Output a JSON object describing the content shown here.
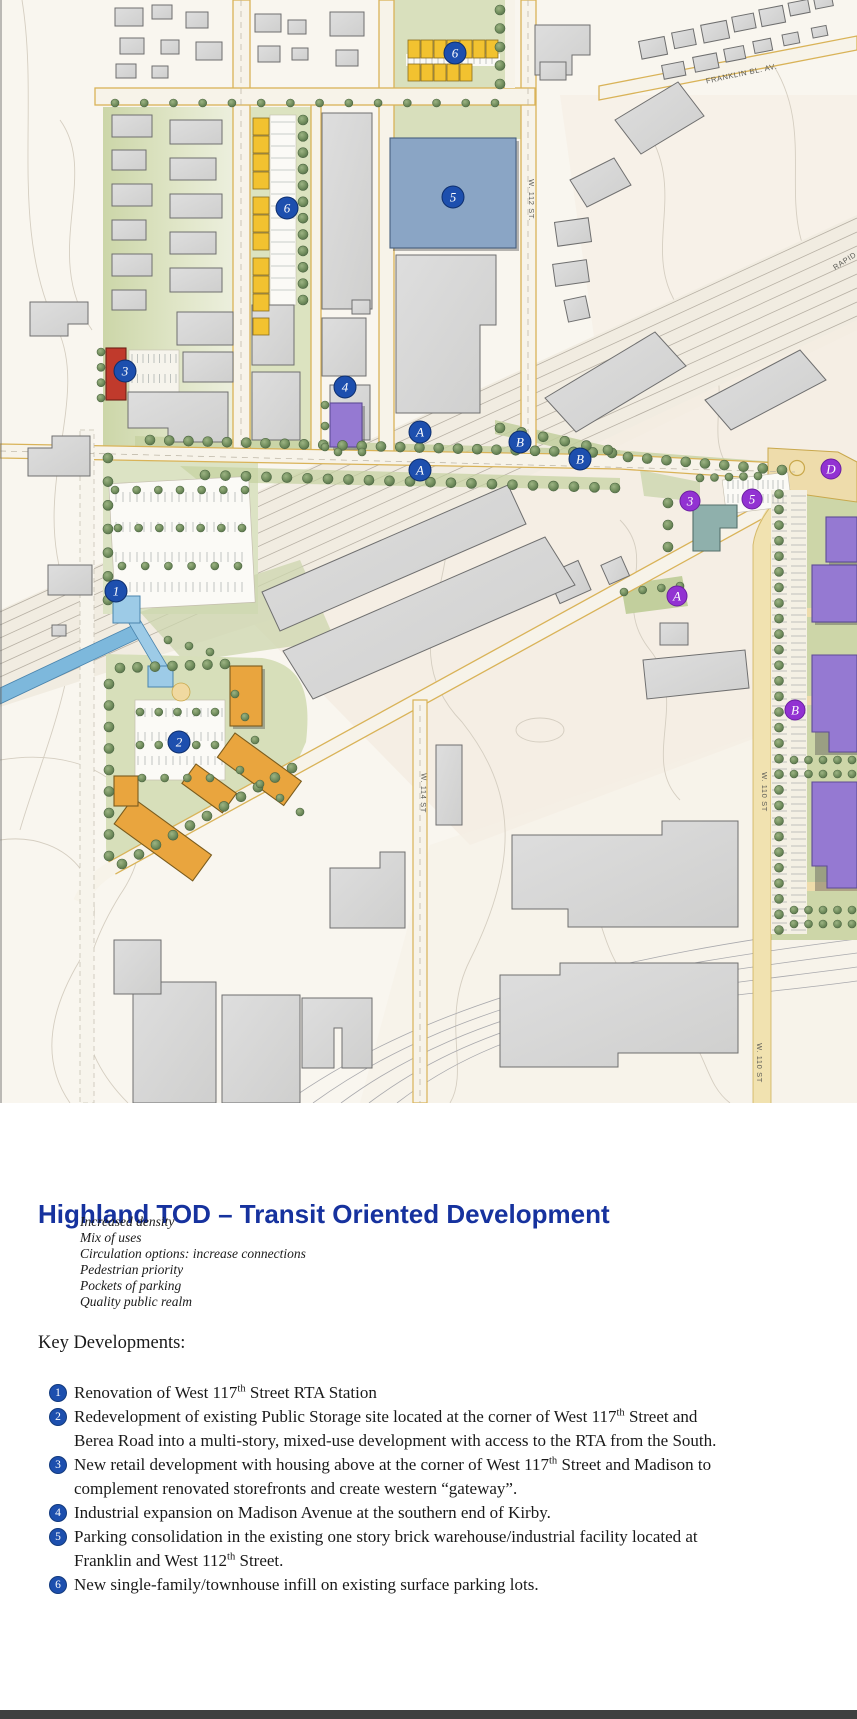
{
  "map": {
    "street_labels": [
      {
        "text": "FRANKLIN BL. AV.",
        "x": 742,
        "y": 76,
        "rot": -12
      },
      {
        "text": "W. 112 ST.",
        "x": 529,
        "y": 200,
        "rot": 90
      },
      {
        "text": "W. 114 ST",
        "x": 421,
        "y": 793,
        "rot": 91
      },
      {
        "text": "W. 110 ST",
        "x": 762,
        "y": 792,
        "rot": 90
      },
      {
        "text": "W. 110 ST",
        "x": 757,
        "y": 1063,
        "rot": 90
      },
      {
        "text": "RAPID",
        "x": 846,
        "y": 263,
        "rot": -33
      }
    ],
    "markers": [
      {
        "label": "1",
        "x": 116,
        "y": 591,
        "type": "blue"
      },
      {
        "label": "2",
        "x": 179,
        "y": 742,
        "type": "blue"
      },
      {
        "label": "3",
        "x": 125,
        "y": 371,
        "type": "blue"
      },
      {
        "label": "4",
        "x": 345,
        "y": 387,
        "type": "blue"
      },
      {
        "label": "5",
        "x": 453,
        "y": 197,
        "type": "blue"
      },
      {
        "label": "6",
        "x": 455,
        "y": 53,
        "type": "blue"
      },
      {
        "label": "6",
        "x": 287,
        "y": 208,
        "type": "blue"
      },
      {
        "label": "A",
        "x": 420,
        "y": 432,
        "type": "blue"
      },
      {
        "label": "A",
        "x": 420,
        "y": 470,
        "type": "blue"
      },
      {
        "label": "B",
        "x": 520,
        "y": 442,
        "type": "blue"
      },
      {
        "label": "B",
        "x": 580,
        "y": 459,
        "type": "blue"
      },
      {
        "label": "3",
        "x": 690,
        "y": 501,
        "type": "purple"
      },
      {
        "label": "5",
        "x": 752,
        "y": 499,
        "type": "purple"
      },
      {
        "label": "D",
        "x": 831,
        "y": 469,
        "type": "purple"
      },
      {
        "label": "A",
        "x": 677,
        "y": 596,
        "type": "purple"
      },
      {
        "label": "B",
        "x": 795,
        "y": 710,
        "type": "purple"
      }
    ],
    "colors": {
      "marker_blue": "#1d4fae",
      "marker_purple": "#9232d2",
      "townhouse_yellow": "#f2c230",
      "mixed_use_orange": "#e9a53e",
      "new_dev_purple": "#9579d2",
      "parking_reuse_blue": "#8aa5c5",
      "retail_red": "#c03a2c",
      "station_light_blue": "#9dcbe7",
      "teal_building": "#8fb0ac"
    }
  },
  "document": {
    "title": "Highland TOD – Transit Oriented Development",
    "principles": [
      "Increased density",
      "Mix of uses",
      "Circulation options: increase connections",
      "Pedestrian priority",
      "Pockets of parking",
      "Quality public realm"
    ],
    "key_developments_heading": "Key Developments:",
    "key_developments": [
      {
        "num": "1",
        "text": "Renovation of West 117th Street RTA Station"
      },
      {
        "num": "2",
        "text": "Redevelopment of existing Public Storage site located at the corner of West 117th Street and Berea Road into a multi-story, mixed-use development with access to the RTA from the South."
      },
      {
        "num": "3",
        "text": "New retail development with housing above at the corner of West 117th Street and Madison to complement renovated storefronts and create western “gateway”."
      },
      {
        "num": "4",
        "text": "Industrial expansion on Madison Avenue at the southern end of Kirby."
      },
      {
        "num": "5",
        "text": "Parking consolidation in the existing one story brick warehouse/industrial facility located at Franklin and West 112th Street."
      },
      {
        "num": "6",
        "text": "New single-family/townhouse infill on existing surface parking lots."
      }
    ]
  }
}
